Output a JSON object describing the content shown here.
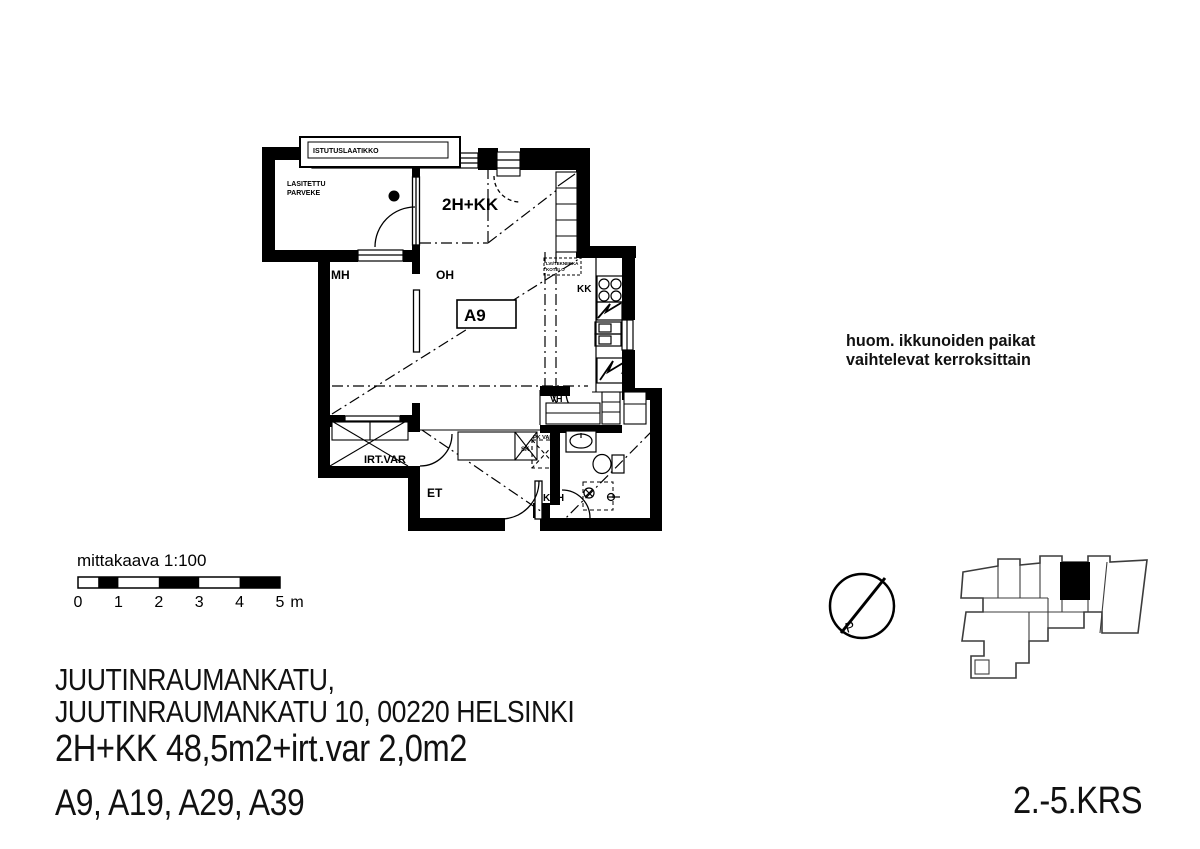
{
  "plan": {
    "unit_label": "2H+KK",
    "apartment_box": "A9",
    "rooms": {
      "balcony_line1": "LASITETTU",
      "balcony_line2": "PARVEKE",
      "planter": "ISTUTUSLAATIKKO",
      "mh": "MH",
      "oh": "OH",
      "kk": "KK",
      "vh": "VH",
      "et": "ET",
      "kph": "KPH",
      "irtvar": "IRT.VAR",
      "sk": "SK",
      "pkvar": "PK VAR",
      "duct_note_line1": "LVI/TEKNIIKKA",
      "duct_note_line2": "KOTELO",
      "jkpk": "JK/PK"
    }
  },
  "note": {
    "line1": "huom. ikkunoiden paikat",
    "line2": "vaihtelevat kerroksittain"
  },
  "scale_bar": {
    "label": "mittakaava 1:100",
    "ticks": [
      "0",
      "1",
      "2",
      "3",
      "4",
      "5"
    ],
    "unit": "m"
  },
  "north": {
    "letter": "P"
  },
  "footer": {
    "address_line1": "JUUTINRAUMANKATU,",
    "address_line2": "JUUTINRAUMANKATU 10, 00220 HELSINKI",
    "size_line": "2H+KK 48,5m2+irt.var 2,0m2",
    "units_line": "A9, A19, A29, A39",
    "floors_label": "2.-5.KRS"
  }
}
